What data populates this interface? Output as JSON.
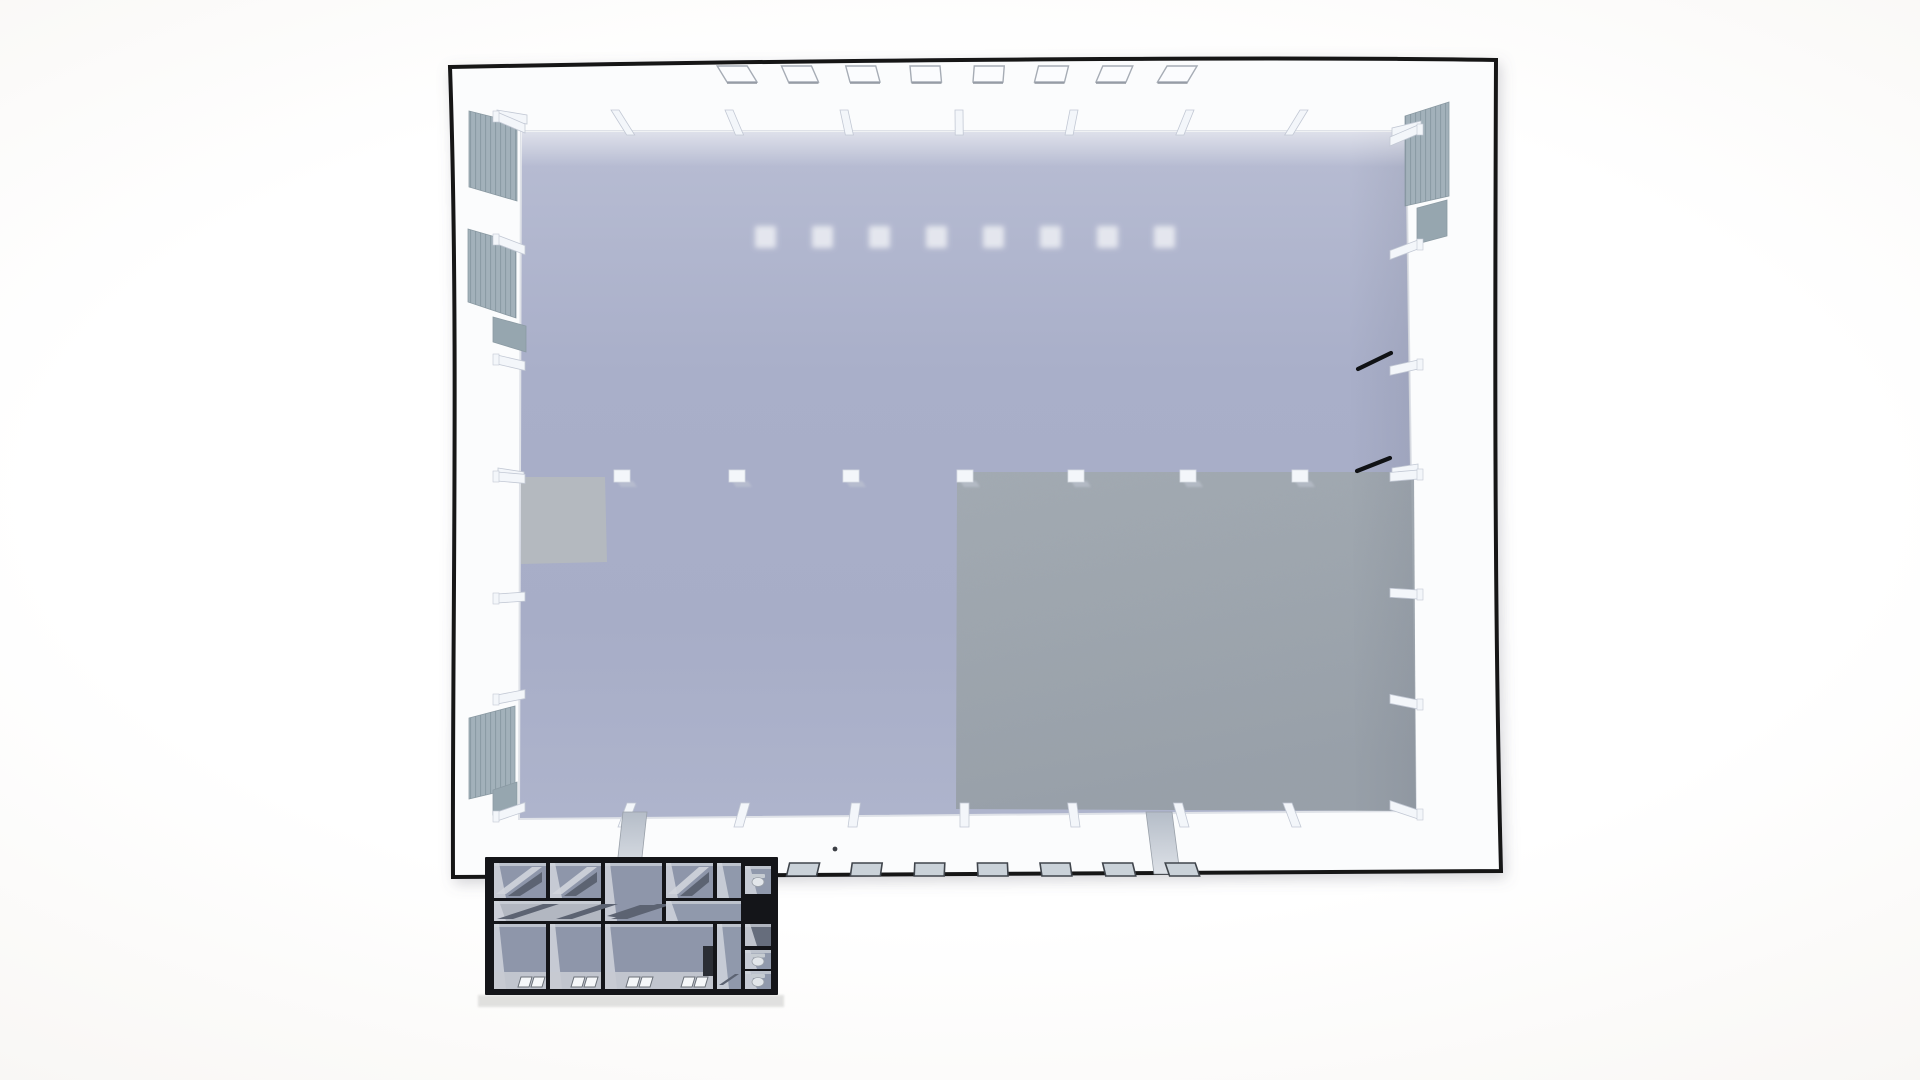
{
  "scene": {
    "description": "top-down-3d-render-of-industrial-hall-with-office-annex",
    "colors": {
      "outline": "#151619",
      "wall": "#fbfcfd",
      "wall_edge": "#dfe2e8",
      "floor_top": "#b8bdd3",
      "floor_mid": "#a8aec9",
      "floor_bottom": "#aeb4cc",
      "dark_zone_top": "#a0a8b1",
      "dark_zone_bottom": "#98a0a9",
      "light_patch": "#b4b9bf",
      "panel": "#a2b1ba",
      "panel_stripe": "#7e909a",
      "panel_small": "#96a6af",
      "column": "#f3f6fa",
      "column_shadow": "#c2c8d4",
      "skylight_fill": "#fbfcfe",
      "skylight_stroke": "#a6acb5",
      "skylight_shadow": "#878e98",
      "floor_light": "#e9ebf1",
      "door_mark": "#101215",
      "facade_window_fill": "#cad2d9",
      "facade_window_stroke": "#40454c",
      "ramp_light": "#dde1e7",
      "ramp_dark": "#b5bdc8",
      "annex_wall": "#141519",
      "annex_floor": "#8e96aa",
      "annex_light": "#d0d4dc",
      "annex_carpet": "#5c6372",
      "annex_corridor": "#b2b7c1",
      "annex_closet": "#2b2e35",
      "annex_toilet": "#e2e6ea",
      "annex_window": "#f5f7f9",
      "ground_strip": "#dcdcda"
    },
    "building": {
      "outline_path": "M 450 67 C 750 61 1250 56 1496 60 C 1495 320 1494 600 1501 871 C 1150 873 800 875 453 877 C 452 640 459 330 450 67 Z",
      "floor_points": "521,131 1406,131 1416,811 519,819"
    },
    "skylights": {
      "count": 8,
      "x_start": 727,
      "spacing": 61.5,
      "y": 66,
      "w": 30,
      "h": 16
    },
    "floor_lights": {
      "count": 8,
      "x_start": 755,
      "spacing": 57,
      "y": 226,
      "size": 21
    },
    "columns": {
      "top_x": [
        611,
        725,
        840,
        955,
        1070,
        1186,
        1300
      ],
      "middle_x": [
        614,
        729,
        843,
        957,
        1068,
        1180,
        1292
      ],
      "middle_y": 470,
      "bottom_x": [
        618,
        734,
        848,
        960,
        1071,
        1180,
        1292
      ],
      "left_wall_y": [
        112,
        235,
        355,
        472,
        594,
        695,
        812
      ],
      "right_wall_y": [
        125,
        240,
        360,
        470,
        590,
        700,
        810
      ]
    },
    "panels": {
      "left": [
        {
          "pts": "469,111 517,123 517,201 469,187",
          "slatted": true
        },
        {
          "pts": "468,229 516,243 516,318 468,302",
          "slatted": true
        },
        {
          "pts": "493,317 526,326 526,352 493,342",
          "slatted": false
        },
        {
          "pts": "469,718 515,706 515,788 469,799",
          "slatted": true
        },
        {
          "pts": "493,790 517,782 517,807 493,815",
          "slatted": false
        }
      ],
      "right": [
        {
          "pts": "1449,102 1405,116 1405,206 1449,196",
          "slatted": true
        },
        {
          "pts": "1447,200 1417,208 1417,244 1447,236",
          "slatted": false
        }
      ]
    },
    "zones": {
      "dark_zone_points": "957,472 1414,472 1416,811 956,809",
      "light_patch_points": "521,477 605,477 607,562 521,564"
    },
    "door_marks": [
      {
        "x1": 1358,
        "y1": 369,
        "x2": 1391,
        "y2": 353
      },
      {
        "x1": 1357,
        "y1": 471,
        "x2": 1390,
        "y2": 458
      }
    ],
    "wall_dot": {
      "cx": 835,
      "cy": 849,
      "r": 2.4
    },
    "facade_windows": {
      "count": 8,
      "x_start": 727,
      "spacing": 62.6,
      "y": 863,
      "w": 30,
      "h": 13
    },
    "ramps": [
      {
        "pts": "623,812 647,812 640,875 616,875"
      },
      {
        "pts": "1146,812 1172,812 1180,874 1154,874"
      }
    ],
    "annex": {
      "frame": {
        "x": 485,
        "y": 857,
        "w": 293,
        "h": 138
      },
      "ground_strip": {
        "x": 478,
        "y": 995,
        "w": 306,
        "h": 12
      },
      "rooms": [
        {
          "kind": "top",
          "x": 494,
          "y": 863,
          "w": 52,
          "h": 35
        },
        {
          "kind": "top",
          "x": 550,
          "y": 863,
          "w": 51,
          "h": 35
        },
        {
          "kind": "big",
          "x": 605,
          "y": 863,
          "w": 57,
          "h": 58
        },
        {
          "kind": "top",
          "x": 666,
          "y": 863,
          "w": 47,
          "h": 35
        },
        {
          "kind": "plain",
          "x": 717,
          "y": 863,
          "w": 24,
          "h": 35
        },
        {
          "kind": "toilet",
          "x": 745,
          "y": 866,
          "w": 26,
          "h": 28
        },
        {
          "kind": "corridor",
          "x": 494,
          "y": 901,
          "w": 107,
          "h": 20
        },
        {
          "kind": "plain",
          "x": 666,
          "y": 901,
          "w": 75,
          "h": 20
        },
        {
          "kind": "bottom",
          "x": 494,
          "y": 924,
          "w": 52,
          "h": 65
        },
        {
          "kind": "bottom",
          "x": 550,
          "y": 924,
          "w": 51,
          "h": 65
        },
        {
          "kind": "bottom",
          "x": 605,
          "y": 924,
          "w": 108,
          "h": 65
        },
        {
          "kind": "strip",
          "x": 717,
          "y": 924,
          "w": 24,
          "h": 65
        },
        {
          "kind": "dark",
          "x": 745,
          "y": 924,
          "w": 26,
          "h": 22
        },
        {
          "kind": "toilet",
          "x": 745,
          "y": 950,
          "w": 26,
          "h": 19
        },
        {
          "kind": "toilet",
          "x": 745,
          "y": 971,
          "w": 26,
          "h": 18
        }
      ],
      "corridor_carpets_x": [
        497,
        556,
        611
      ],
      "big_room_carpet": "607,916 640,905 660,905 627,919",
      "strip_carpet": "719,985 735,974 739,974 723,985",
      "windows_x": [
        518,
        571,
        626,
        681
      ],
      "closet": {
        "x": 703,
        "y": 946,
        "w": 10,
        "h": 30
      }
    }
  }
}
